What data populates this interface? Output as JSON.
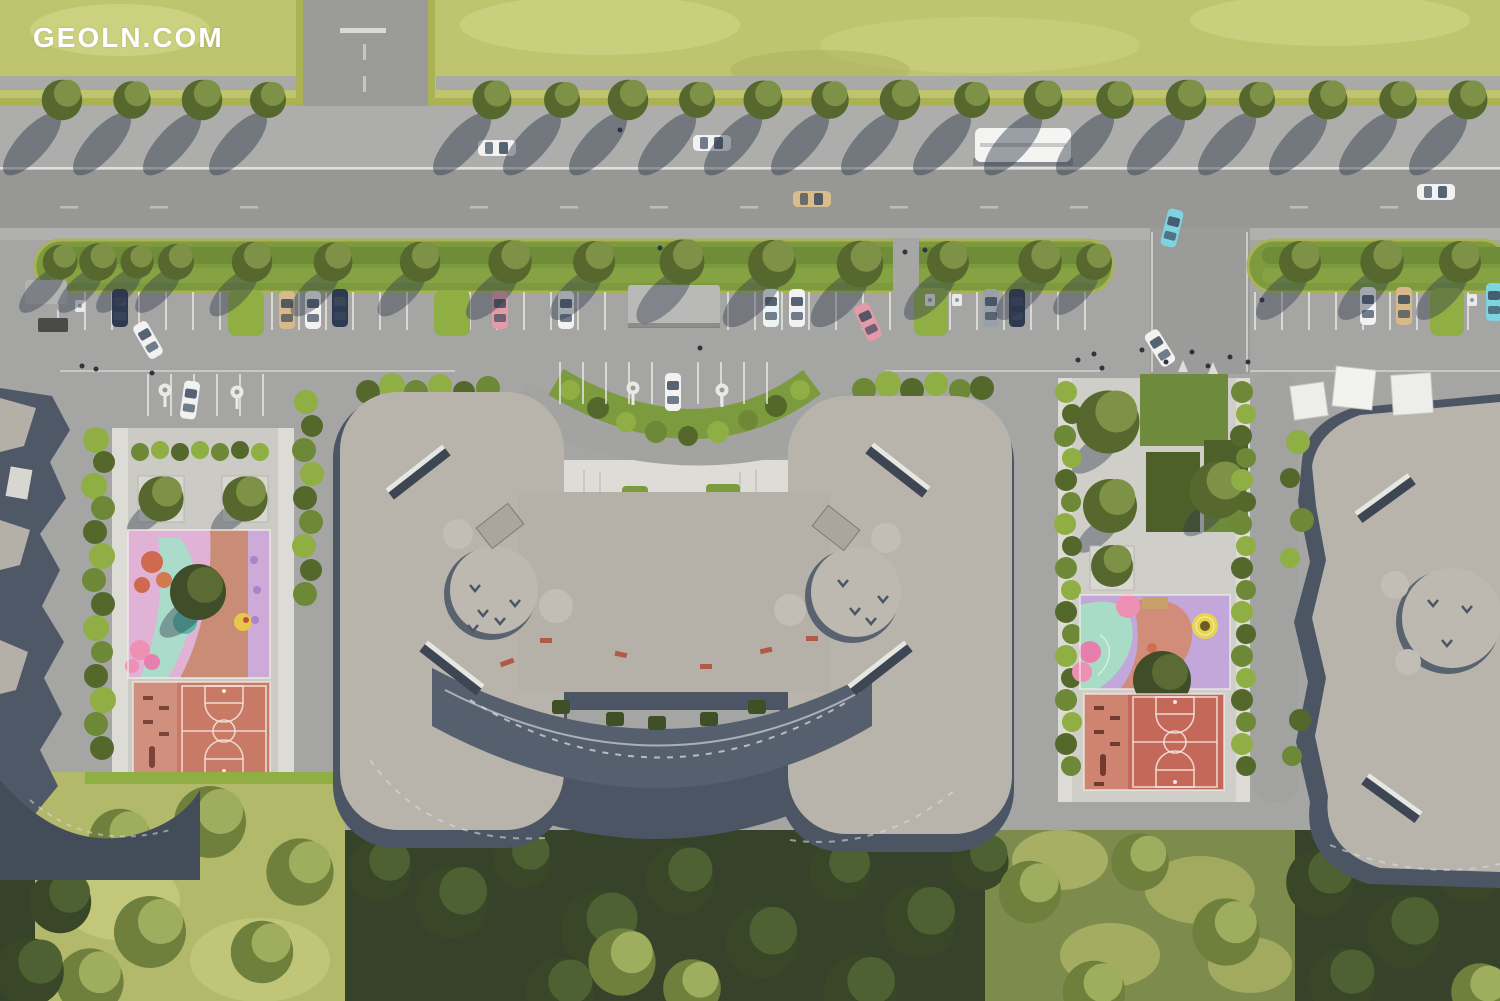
{
  "watermark": {
    "text": "GEOLN.COM",
    "color": "#ffffff"
  },
  "scene": {
    "type": "aerial-render",
    "subject": "Top-down aerial 3D render of a residential complex master plan with street parking, landscaped courtyards, playgrounds, basketball courts and a tree park",
    "buildings": [
      {
        "id": "left-building",
        "note": "partially visible at left edge"
      },
      {
        "id": "central-building",
        "note": "large butterfly-shaped block with two round roof cores and arc entrance court"
      },
      {
        "id": "right-building",
        "note": "partially visible at right edge with white canopies at entrance"
      }
    ],
    "amenities": [
      "entrance court with hedge crescent",
      "guest parking rows",
      "street parking with hedge dividers and shelter",
      "bus on street",
      "children playground left courtyard",
      "basketball and workout court left courtyard",
      "garden plots right courtyard",
      "children playground right courtyard",
      "basketball and workout court right courtyard",
      "tree park at bottom"
    ],
    "vehicles": {
      "bus_count": 1,
      "parked_cars": 16,
      "moving_cars": 7,
      "car_colors": [
        "white",
        "navy",
        "tan",
        "pink",
        "gray",
        "cyan"
      ]
    },
    "palette": {
      "lawn": "#bfc46f",
      "lawn_bright": "#d2d787",
      "grass_median": "#7e9a3e",
      "hedge": "#8fae43",
      "hedge_dark": "#55682c",
      "forest": "#45532d",
      "forest_shadow": "#36422a",
      "forest_light": "#7d8b4c",
      "asphalt": "#a5a5a3",
      "road": "#979795",
      "sidewalk": "#adadab",
      "white_paving": "#dedcd6",
      "line_white": "#e9e9e6",
      "roof": "#b8b4ac",
      "roof_light": "#c0bcb4",
      "facade": "#4b5563",
      "court": "#c4705e",
      "court_fitness": "#d1907e",
      "play_pink": "#dfb2d6",
      "play_mint": "#a9dcc6",
      "play_lavender": "#c3a6da",
      "play_salmon": "#d28d7a",
      "accent_pink": "#ee8fb4",
      "accent_yellow": "#e8d44f",
      "accent_orange": "#cf6a4e",
      "accent_teal": "#58b9a8",
      "shadow": "#2e3848",
      "watermark_color": "#ffffff"
    }
  }
}
